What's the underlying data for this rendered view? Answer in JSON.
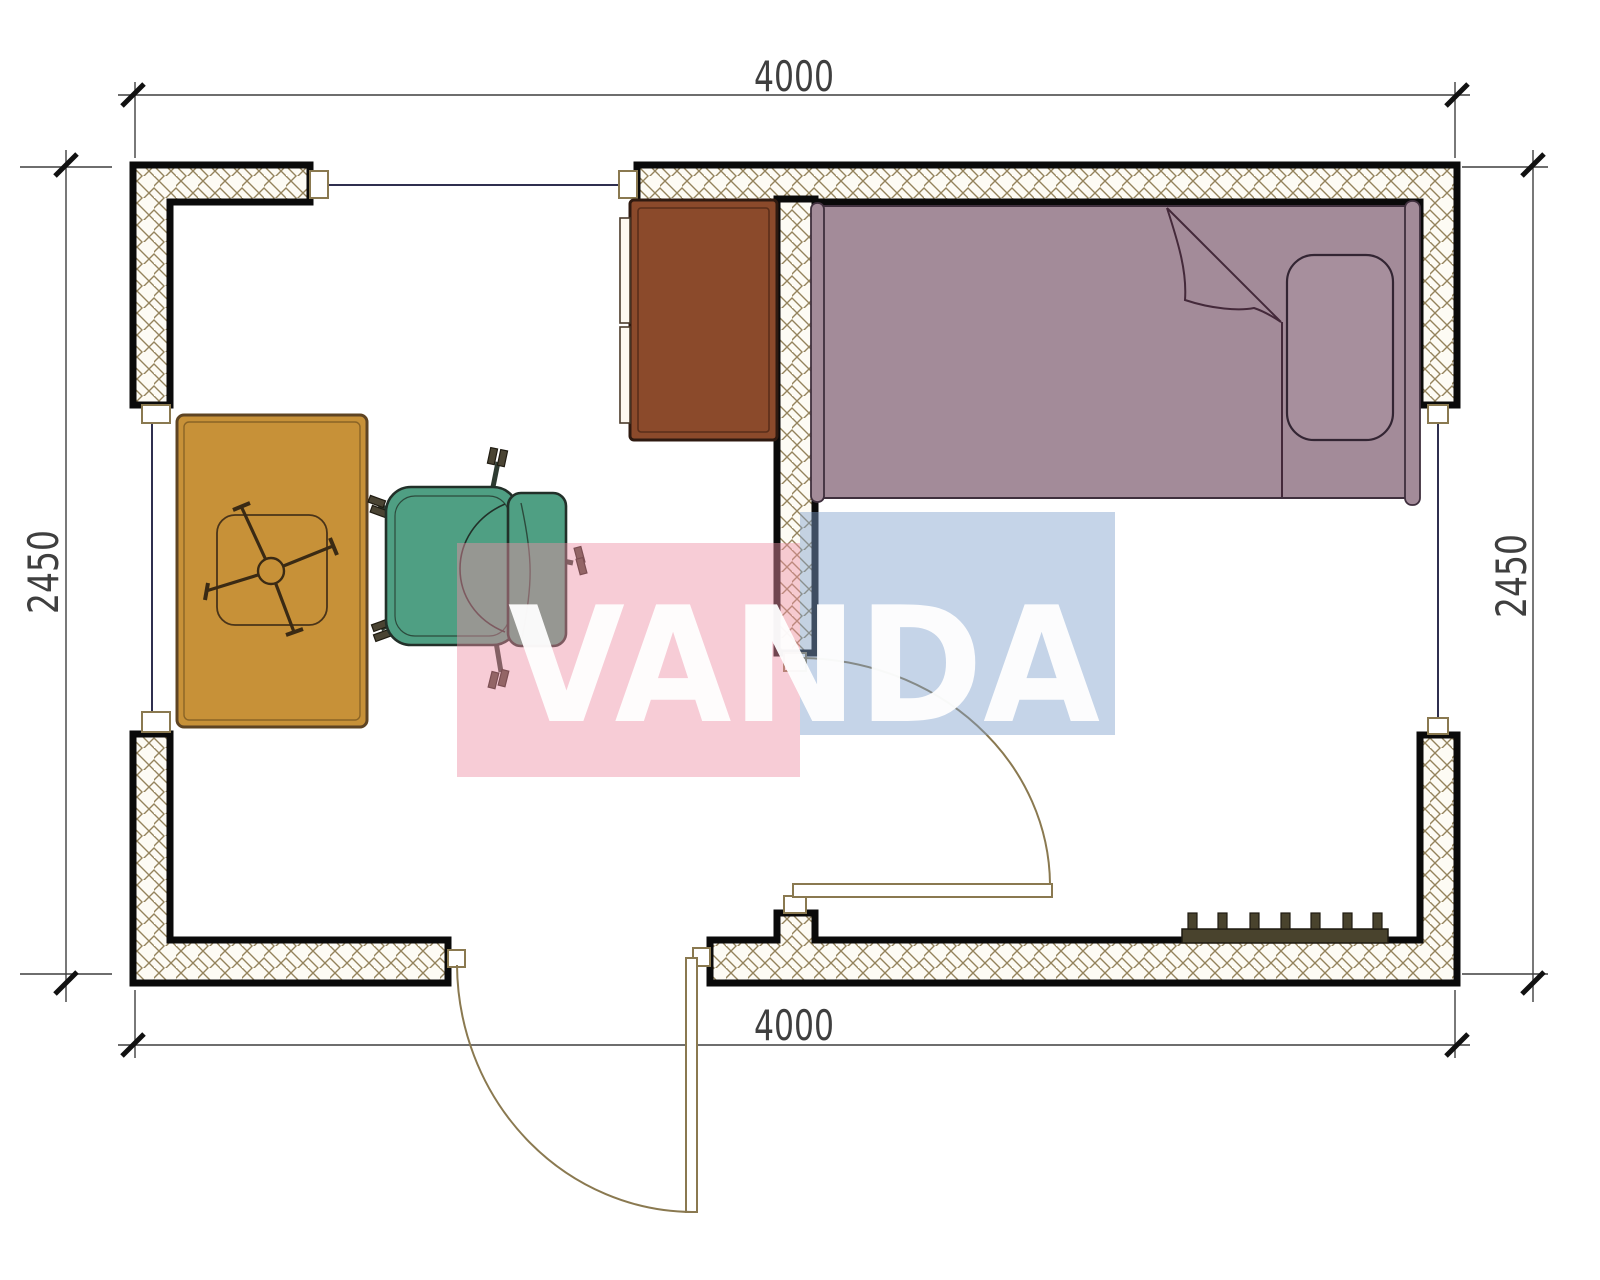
{
  "drawing": {
    "type": "floor-plan",
    "room": {
      "width_label": "4000",
      "depth_label": "2450"
    },
    "dimensions": {
      "top": "4000",
      "bottom": "4000",
      "left": "2450",
      "right": "2450"
    },
    "watermark": {
      "text": "VANDA",
      "pink_block_color": "#ee8ea4",
      "blue_block_color": "#7fa0cc",
      "text_color": "#ffffff"
    },
    "elements": [
      {
        "name": "exterior-walls",
        "fill": "hatch",
        "outline": "#0a0a0a"
      },
      {
        "name": "interior-partition-wall",
        "fill": "hatch",
        "outline": "#0a0a0a"
      },
      {
        "name": "window-top",
        "line_color": "#2f2f4f"
      },
      {
        "name": "window-left",
        "line_color": "#2f2f4f"
      },
      {
        "name": "window-right",
        "line_color": "#2f2f4f"
      },
      {
        "name": "interior-door-with-swing",
        "line_color": "#8a7950"
      },
      {
        "name": "entry-door-with-swing",
        "line_color": "#8a7950"
      },
      {
        "name": "single-bed",
        "color": "#a38b99"
      },
      {
        "name": "pillow",
        "color": "#a38b99"
      },
      {
        "name": "desk-table",
        "color": "#c79138"
      },
      {
        "name": "office-chair",
        "color": "#4f9f83"
      },
      {
        "name": "cabinet",
        "color": "#8b4a2b"
      },
      {
        "name": "radiator",
        "color": "#49432d",
        "fins": 7
      }
    ]
  }
}
